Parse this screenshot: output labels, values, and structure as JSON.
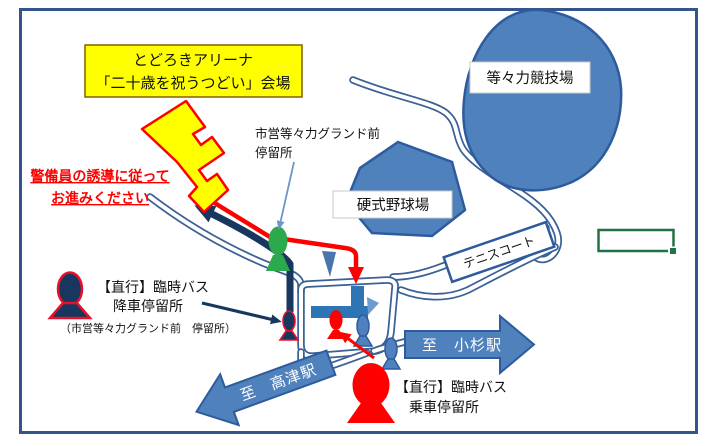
{
  "map": {
    "venue_box": {
      "line1": "とどろきアリーナ",
      "line2": "「二十歳を祝うつどい」会場"
    },
    "warning": {
      "line1": "警備員の誘導に従って",
      "line2": "お進みください"
    },
    "grand_mae_stop": {
      "line1": "市営等々力グランド前",
      "line2": "停留所"
    },
    "athletics_stadium_label": "等々力競技場",
    "baseball_field_label": "硬式野球場",
    "tennis_court_label": "テニスコート",
    "alight_stop": {
      "line1": "【直行】臨時バス",
      "line2": "降車停留所",
      "line3": "（市営等々力グランド前　停留所）"
    },
    "board_stop": {
      "line1": "【直行】臨時バス",
      "line2": "乗車停留所"
    },
    "to_kosugi_label": "至　小杉駅",
    "to_takatsu_label": "至　高津駅",
    "colors": {
      "map_blue": "#4F81BD",
      "map_blue_dark": "#2E5B9E",
      "road_blue": "#3A6096",
      "route_navy": "#17375E",
      "route_red": "#FF0000",
      "venue_yellow": "#FFFF00",
      "marker_green": "#2BA94C",
      "excel_selection_green": "#217346",
      "frame_navy": "#35548C"
    }
  }
}
